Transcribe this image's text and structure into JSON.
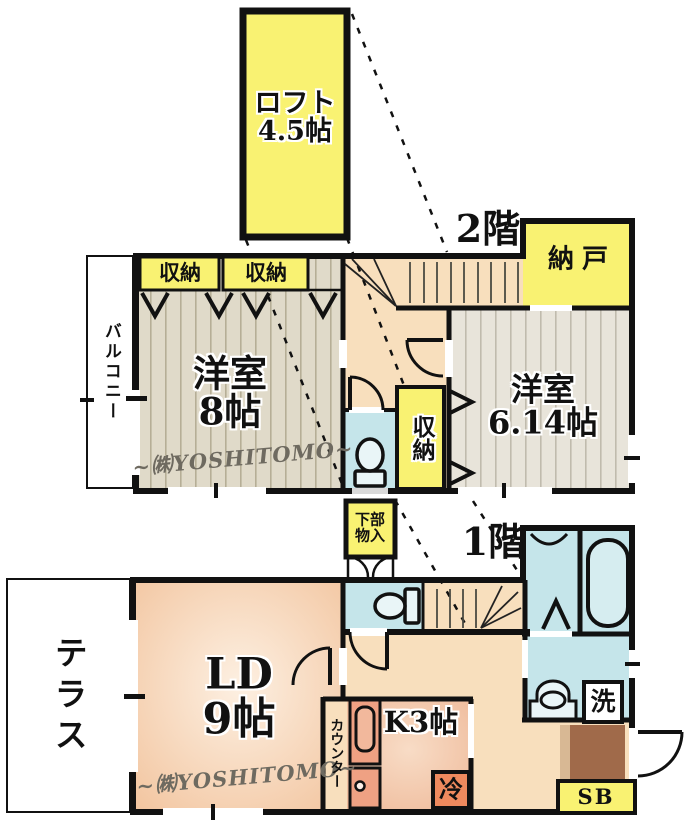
{
  "palette": {
    "yellow": "#f9f272",
    "peach": "#f8dfbd",
    "blue": "#c5e5ea",
    "stripe_base_8": "#e0dac9",
    "stripe_base_614": "#e8e4da",
    "brown": "#a06a4a",
    "tan": "#d8b894",
    "unit_orange": "#efa183",
    "fridge_orange": "#ef8a5e",
    "wall": "#111111"
  },
  "loft": {
    "name": "ロフト",
    "size": "4.5帖"
  },
  "floor2": {
    "title": "2階",
    "balcony": "バルコニー",
    "closet1": "収納",
    "closet2": "収納",
    "closet_mid": "収納",
    "storeroom": "納戸",
    "room8": {
      "name": "洋室",
      "size": "8帖"
    },
    "room614": {
      "name": "洋室",
      "size": "6.14帖"
    },
    "watermark": "~㈱YOSHITOMO~"
  },
  "between": {
    "line1": "下部",
    "line2": "物入"
  },
  "floor1": {
    "title": "1階",
    "terrace": "テラス",
    "ld": {
      "name": "LD",
      "size": "9帖"
    },
    "kitchen": "K3帖",
    "counter": "カウンター",
    "fridge": "冷",
    "wash": "洗",
    "shoebox": "SB",
    "watermark": "~㈱YOSHITOMO~"
  }
}
